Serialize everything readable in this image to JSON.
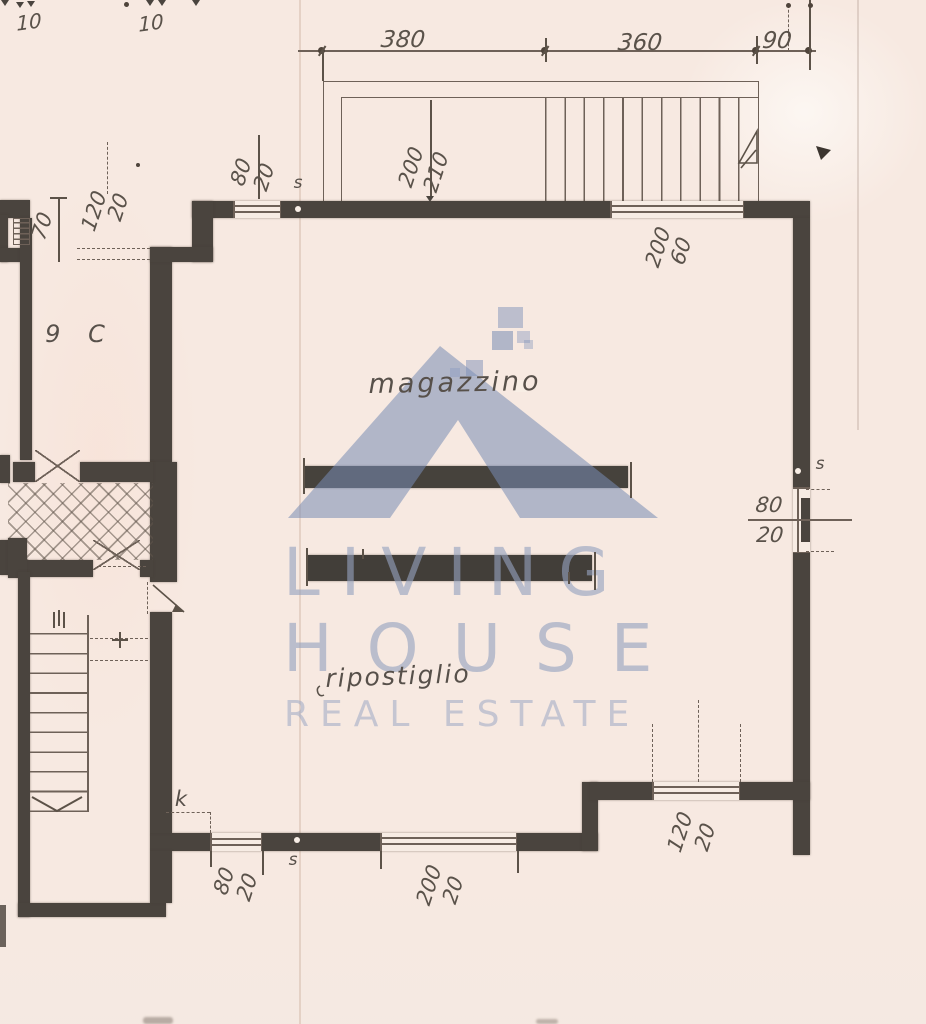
{
  "watermark": {
    "l1": "LIVING",
    "l2": "HOUSE",
    "l3": "REAL ESTATE"
  },
  "rooms": {
    "room9c": "9 C",
    "magazzino": "magazzino",
    "ripostiglio": "ripostiglio"
  },
  "marks": {
    "k": "k",
    "s_top": "s",
    "s_right": "s",
    "s_bottom": "s"
  },
  "dims": {
    "ten_a": "10",
    "ten_b": "10",
    "top_w1": "380",
    "top_w2": "360",
    "top_w3": "90",
    "stair_a": "200",
    "stair_b": "210",
    "win_top_small_a": "80",
    "win_top_small_b": "20",
    "win_top_big_a": "200",
    "win_top_big_b": "60",
    "niche": "70",
    "door_left_a": "120",
    "door_left_b": "20",
    "win_right_a": "80",
    "win_right_b": "20",
    "door_bottom_a": "80",
    "door_bottom_b": "20",
    "win_bottom_a": "200",
    "win_bottom_b": "20",
    "win_br_a": "120",
    "win_br_b": "20"
  },
  "colors": {
    "paper": "#f7e9e1",
    "wall": "#4a443e",
    "line": "#6e6158",
    "ink": "#5a524a",
    "watermark_blue": "#94a1be"
  }
}
